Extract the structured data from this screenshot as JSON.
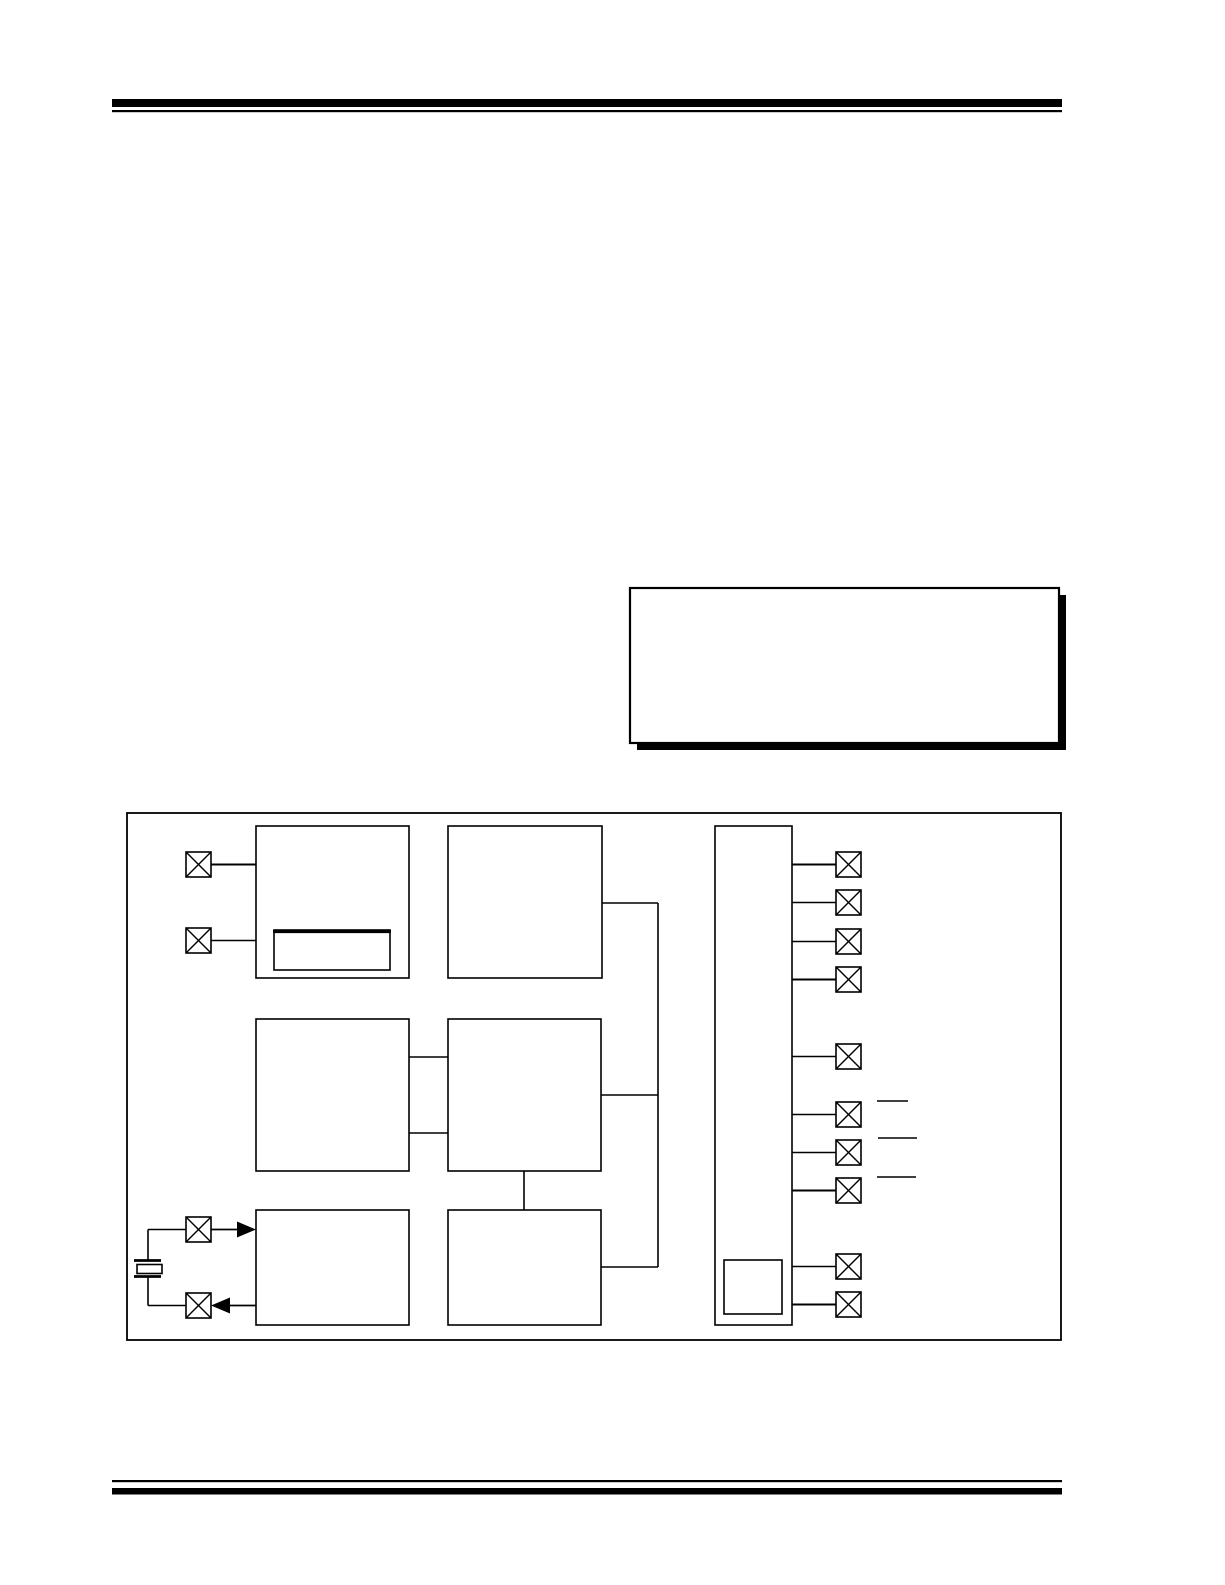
{
  "page": {
    "width": 1225,
    "height": 1585
  },
  "colors": {
    "paper": "#ffffff",
    "ink": "#000000"
  },
  "figure_description": {
    "kind": "block-diagram",
    "blocks": 8,
    "sub_blocks": 2,
    "pin_pads_left": 4,
    "pin_pads_right": 10,
    "has_crystal_symbol": true,
    "note_box_empty": true
  },
  "shapes": [
    {
      "kind": "bar",
      "name": "header-rule-thick",
      "x": 112,
      "y": 99,
      "w": 950,
      "h": 8
    },
    {
      "kind": "bar",
      "name": "header-rule-thin",
      "x": 112,
      "y": 110,
      "w": 950,
      "h": 2.2
    },
    {
      "kind": "bar",
      "name": "note-box-shadow",
      "x": 637,
      "y": 595,
      "w": 429,
      "h": 155
    },
    {
      "kind": "box",
      "name": "note-box",
      "x": 630,
      "y": 588,
      "w": 429,
      "h": 155,
      "fill": "#ffffff",
      "sw": 2.2
    },
    {
      "kind": "box",
      "name": "figure-frame",
      "x": 127,
      "y": 813,
      "w": 934,
      "h": 527,
      "sw": 1.8
    },
    {
      "kind": "box",
      "name": "block-top-left",
      "x": 256,
      "y": 826,
      "w": 153,
      "h": 152,
      "sw": 1.6
    },
    {
      "kind": "box",
      "name": "block-top-left-subblock",
      "x": 274,
      "y": 930,
      "w": 116,
      "h": 40,
      "sw": 1.6
    },
    {
      "kind": "line",
      "name": "block-top-left-subblock-top-edge",
      "x1": 273,
      "y1": 931.5,
      "x2": 391,
      "y2": 931.5,
      "wd": 3.2
    },
    {
      "kind": "box",
      "name": "block-top-middle",
      "x": 448,
      "y": 826,
      "w": 154,
      "h": 152,
      "sw": 1.6
    },
    {
      "kind": "box",
      "name": "block-mid-left",
      "x": 256,
      "y": 1019,
      "w": 153,
      "h": 152,
      "sw": 1.6
    },
    {
      "kind": "box",
      "name": "block-mid-middle",
      "x": 448,
      "y": 1019,
      "w": 153,
      "h": 152,
      "sw": 1.6
    },
    {
      "kind": "box",
      "name": "block-bottom-left",
      "x": 256,
      "y": 1210,
      "w": 153,
      "h": 115,
      "sw": 1.6
    },
    {
      "kind": "box",
      "name": "block-bottom-middle",
      "x": 448,
      "y": 1210,
      "w": 153,
      "h": 115,
      "sw": 1.6
    },
    {
      "kind": "box",
      "name": "block-tall-right",
      "x": 715,
      "y": 826,
      "w": 77,
      "h": 499,
      "sw": 1.6
    },
    {
      "kind": "box",
      "name": "block-tall-right-subblock",
      "x": 724,
      "y": 1260,
      "w": 58,
      "h": 54,
      "sw": 1.6
    },
    {
      "kind": "line",
      "name": "wire-leftpad1-to-topleft",
      "x1": 211,
      "y1": 864.5,
      "x2": 256,
      "y2": 864.5,
      "wd": 2.0
    },
    {
      "kind": "line",
      "name": "wire-leftpad2-to-topleft",
      "x1": 211,
      "y1": 940.5,
      "x2": 256,
      "y2": 940.5,
      "wd": 1.6
    },
    {
      "kind": "line",
      "name": "wire-midleft-midmiddle-upper",
      "x1": 409,
      "y1": 1057,
      "x2": 448,
      "y2": 1057,
      "wd": 1.6
    },
    {
      "kind": "line",
      "name": "wire-midleft-midmiddle-lower",
      "x1": 409,
      "y1": 1133,
      "x2": 448,
      "y2": 1133,
      "wd": 1.6
    },
    {
      "kind": "line",
      "name": "wire-topmiddle-to-bus",
      "x1": 602,
      "y1": 903,
      "x2": 658,
      "y2": 903,
      "wd": 1.6
    },
    {
      "kind": "line",
      "name": "wire-midmiddle-to-bus",
      "x1": 601,
      "y1": 1095,
      "x2": 658,
      "y2": 1095,
      "wd": 1.6
    },
    {
      "kind": "line",
      "name": "bus-vertical",
      "x1": 658,
      "y1": 903,
      "x2": 658,
      "y2": 1267,
      "wd": 1.6
    },
    {
      "kind": "line",
      "name": "wire-bus-to-bottommiddle",
      "x1": 601,
      "y1": 1267,
      "x2": 658,
      "y2": 1267,
      "wd": 1.6
    },
    {
      "kind": "line",
      "name": "wire-midmiddle-to-bottommiddle",
      "x1": 524,
      "y1": 1171,
      "x2": 524,
      "y2": 1210,
      "wd": 1.6
    },
    {
      "kind": "line",
      "name": "wire-tall-to-rightpad-1",
      "x1": 792,
      "y1": 864.5,
      "x2": 836,
      "y2": 864.5,
      "wd": 2.0
    },
    {
      "kind": "line",
      "name": "wire-tall-to-rightpad-2",
      "x1": 792,
      "y1": 902.5,
      "x2": 836,
      "y2": 902.5,
      "wd": 1.6
    },
    {
      "kind": "line",
      "name": "wire-tall-to-rightpad-3",
      "x1": 792,
      "y1": 941.5,
      "x2": 836,
      "y2": 941.5,
      "wd": 1.6
    },
    {
      "kind": "line",
      "name": "wire-tall-to-rightpad-4",
      "x1": 792,
      "y1": 979.5,
      "x2": 836,
      "y2": 979.5,
      "wd": 2.0
    },
    {
      "kind": "line",
      "name": "wire-tall-to-rightpad-5",
      "x1": 792,
      "y1": 1056.5,
      "x2": 836,
      "y2": 1056.5,
      "wd": 1.6
    },
    {
      "kind": "line",
      "name": "wire-tall-to-rightpad-6",
      "x1": 792,
      "y1": 1114.5,
      "x2": 836,
      "y2": 1114.5,
      "wd": 1.6
    },
    {
      "kind": "line",
      "name": "wire-tall-to-rightpad-7",
      "x1": 792,
      "y1": 1152.5,
      "x2": 836,
      "y2": 1152.5,
      "wd": 1.6
    },
    {
      "kind": "line",
      "name": "wire-tall-to-rightpad-8",
      "x1": 792,
      "y1": 1190.5,
      "x2": 836,
      "y2": 1190.5,
      "wd": 2.0
    },
    {
      "kind": "line",
      "name": "wire-tall-to-rightpad-9",
      "x1": 792,
      "y1": 1266.5,
      "x2": 836,
      "y2": 1266.5,
      "wd": 1.6
    },
    {
      "kind": "line",
      "name": "wire-tall-to-rightpad-10",
      "x1": 792,
      "y1": 1304.5,
      "x2": 836,
      "y2": 1304.5,
      "wd": 2.0
    },
    {
      "kind": "line",
      "name": "signal-overbar-1",
      "x1": 877,
      "y1": 1101,
      "x2": 908,
      "y2": 1101,
      "wd": 1.6
    },
    {
      "kind": "line",
      "name": "signal-overbar-2",
      "x1": 878,
      "y1": 1138,
      "x2": 917,
      "y2": 1138,
      "wd": 1.6
    },
    {
      "kind": "line",
      "name": "signal-overbar-3",
      "x1": 877,
      "y1": 1177,
      "x2": 916,
      "y2": 1177,
      "wd": 1.6
    },
    {
      "kind": "line",
      "name": "crystal-wire-top-h",
      "x1": 148,
      "y1": 1229.5,
      "x2": 186,
      "y2": 1229.5,
      "wd": 1.6
    },
    {
      "kind": "line",
      "name": "crystal-wire-top-v",
      "x1": 148,
      "y1": 1229.5,
      "x2": 148,
      "y2": 1260,
      "wd": 1.6
    },
    {
      "kind": "line",
      "name": "crystal-plate-top",
      "x1": 134,
      "y1": 1260.5,
      "x2": 161,
      "y2": 1260.5,
      "wd": 2.8
    },
    {
      "kind": "box",
      "name": "crystal-body",
      "x": 137,
      "y": 1264.5,
      "w": 25,
      "h": 9,
      "fill": "#ffffff",
      "sw": 1.6
    },
    {
      "kind": "line",
      "name": "crystal-plate-bottom",
      "x1": 134,
      "y1": 1276.5,
      "x2": 161,
      "y2": 1276.5,
      "wd": 2.8
    },
    {
      "kind": "line",
      "name": "crystal-wire-bottom-v",
      "x1": 148,
      "y1": 1276.5,
      "x2": 148,
      "y2": 1305.5,
      "wd": 1.6
    },
    {
      "kind": "line",
      "name": "crystal-wire-bottom-h",
      "x1": 148,
      "y1": 1305.5,
      "x2": 186,
      "y2": 1305.5,
      "wd": 1.6
    },
    {
      "kind": "line",
      "name": "wire-xtalpad1-to-block",
      "x1": 211,
      "y1": 1229.5,
      "x2": 241,
      "y2": 1229.5,
      "wd": 1.8
    },
    {
      "kind": "tri",
      "name": "arrowhead-into-block-bottom-left",
      "points": "256,1229.5 237,1221.5 237,1237.5"
    },
    {
      "kind": "line",
      "name": "wire-block-to-xtalpad2",
      "x1": 229,
      "y1": 1305.5,
      "x2": 256,
      "y2": 1305.5,
      "wd": 1.8
    },
    {
      "kind": "tri",
      "name": "arrowhead-into-xtalpad2",
      "points": "211,1305.5 230,1297.5 230,1313.5"
    },
    {
      "kind": "pin",
      "name": "pin-pad-left-1",
      "x": 186,
      "y": 852,
      "s": 25
    },
    {
      "kind": "pin",
      "name": "pin-pad-left-2",
      "x": 186,
      "y": 928,
      "s": 25
    },
    {
      "kind": "pin",
      "name": "pin-pad-left-3",
      "x": 186,
      "y": 1217,
      "s": 25
    },
    {
      "kind": "pin",
      "name": "pin-pad-left-4",
      "x": 186,
      "y": 1293,
      "s": 25
    },
    {
      "kind": "pin",
      "name": "pin-pad-right-1",
      "x": 836,
      "y": 852,
      "s": 25
    },
    {
      "kind": "pin",
      "name": "pin-pad-right-2",
      "x": 836,
      "y": 890,
      "s": 25
    },
    {
      "kind": "pin",
      "name": "pin-pad-right-3",
      "x": 836,
      "y": 929,
      "s": 25
    },
    {
      "kind": "pin",
      "name": "pin-pad-right-4",
      "x": 836,
      "y": 967,
      "s": 25
    },
    {
      "kind": "pin",
      "name": "pin-pad-right-5",
      "x": 836,
      "y": 1044,
      "s": 25
    },
    {
      "kind": "pin",
      "name": "pin-pad-right-6",
      "x": 836,
      "y": 1102,
      "s": 25
    },
    {
      "kind": "pin",
      "name": "pin-pad-right-7",
      "x": 836,
      "y": 1140,
      "s": 25
    },
    {
      "kind": "pin",
      "name": "pin-pad-right-8",
      "x": 836,
      "y": 1178,
      "s": 25
    },
    {
      "kind": "pin",
      "name": "pin-pad-right-9",
      "x": 836,
      "y": 1254,
      "s": 25
    },
    {
      "kind": "pin",
      "name": "pin-pad-right-10",
      "x": 836,
      "y": 1292,
      "s": 25
    },
    {
      "kind": "bar",
      "name": "footer-rule-thin",
      "x": 112,
      "y": 1480,
      "w": 950,
      "h": 2.2
    },
    {
      "kind": "bar",
      "name": "footer-rule-thick",
      "x": 112,
      "y": 1488,
      "w": 950,
      "h": 6.5
    }
  ]
}
